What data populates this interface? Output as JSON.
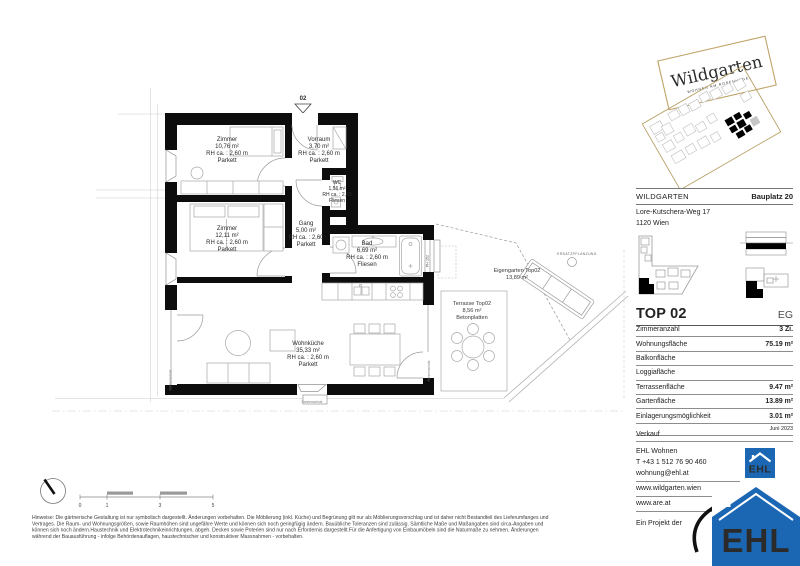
{
  "plan": {
    "entry_label": "02",
    "rooms": {
      "zimmer1": {
        "name": "Zimmer",
        "area": "10,76 m²",
        "rh": "RH ca. : 2,60 m",
        "floor": "Parkett"
      },
      "vorraum": {
        "name": "Vorraum",
        "area": "3,70 m²",
        "rh": "RH ca. : 2,60 m",
        "floor": "Parkett"
      },
      "wc": {
        "name": "WC",
        "area": "1,56 m²",
        "rh": "RH ca. : 2,60",
        "floor": "Fliesen"
      },
      "zimmer2": {
        "name": "Zimmer",
        "area": "12,11 m²",
        "rh": "RH ca. : 2,60 m",
        "floor": "Parkett"
      },
      "gang": {
        "name": "Gang",
        "area": "5,00 m²",
        "rh": "RH ca. : 2,60",
        "floor": "Parkett"
      },
      "bad": {
        "name": "Bad",
        "area": "6,69 m²",
        "rh": "RH ca. : 2,60 m",
        "floor": "Fliesen"
      },
      "wohnkueche": {
        "name": "Wohnküche",
        "area": "35,33 m²",
        "rh": "RH ca. : 2,60 m",
        "floor": "Parkett"
      }
    },
    "outdoor": {
      "eigengarten": {
        "name": "Eigengarten Top02",
        "area": "13,89 m²"
      },
      "terrasse": {
        "name": "Terrasse Top02",
        "area": "8,56 m²",
        "floor": "Betonplatten"
      },
      "ersatzpflanzung": "ERSATZPFLANZUNG"
    },
    "annotations": {
      "sonnenschutz": "Sonnenschutz",
      "parapet": "PH 152"
    },
    "scale": {
      "labels": [
        "0",
        "1",
        "3",
        "5"
      ]
    }
  },
  "brand": {
    "wildgarten_logo": "Wildgarten",
    "wildgarten_tagline": "WOHNEN AM ROSENHÜGEL",
    "colors": {
      "gold": "#b8a269",
      "brown": "#9a6632",
      "ehl_blue": "#1b67b3"
    }
  },
  "sidebar": {
    "project": "WILDGARTEN",
    "bauplatz": "Bauplatz 20",
    "address_line1": "Lore-Kutschera-Weg 17",
    "address_line2": "1120 Wien",
    "unit": "TOP 02",
    "floor": "EG",
    "table": {
      "rows": [
        {
          "label": "Zimmeranzahl",
          "value": "3 Zi."
        },
        {
          "label": "Wohnungsfläche",
          "value": "75.19 m²"
        },
        {
          "label": "Balkonfläche",
          "value": ""
        },
        {
          "label": "Loggiafläche",
          "value": ""
        },
        {
          "label": "Terrassenfläche",
          "value": "9.47 m²"
        },
        {
          "label": "Gartenfläche",
          "value": "13.89 m²"
        },
        {
          "label": "Einlagerungsmöglichkeit",
          "value": "3.01 m²"
        }
      ]
    },
    "date": "Juni 2023",
    "contact": {
      "heading": "Verkauf",
      "company": "EHL Wohnen",
      "phone": "T +43 1 512 76 90 460",
      "email": "wohnung@ehl.at",
      "web1": "www.wildgarten.wien",
      "web2": "www.are.at",
      "project_of": "Ein Projekt der"
    },
    "ehl_logo_text": "EHL"
  },
  "footer": {
    "disclaimer_lines": [
      "Hinweise: Die gärtnerische Gestaltung ist nur symbolisch dargestellt. Änderungen vorbehalten. Die Möblierung (inkl. Küche) und Begrünung gilt nur als Möblierungsvorschlag und ist daher nicht Bestandteil des Lieferumfanges und",
      "Vertrages. Die Raum- und Wohnungsgrößen, sowie Raumhöhen sind ungefähre Werte und können sich noch geringfügig ändern. Bauübliche Toleranzen sind zulässig. Sämtliche Maße und Maßangaben sind circa-Angaben und",
      "können sich noch ändern.Haustechnik und Elektrotechnikeinrichtungen, abgeh. Decken sowie Poterien sind nur nach Erfordernis dargestellt.Für die Anfertigung von Einbaumöbeln sind die Naturmaße zu nehmen. Änderungen",
      "während der Bauausführung - infolge Behördenauflagen, haustechnischer und konstruktiver Massnahmen - vorbehalten."
    ]
  }
}
